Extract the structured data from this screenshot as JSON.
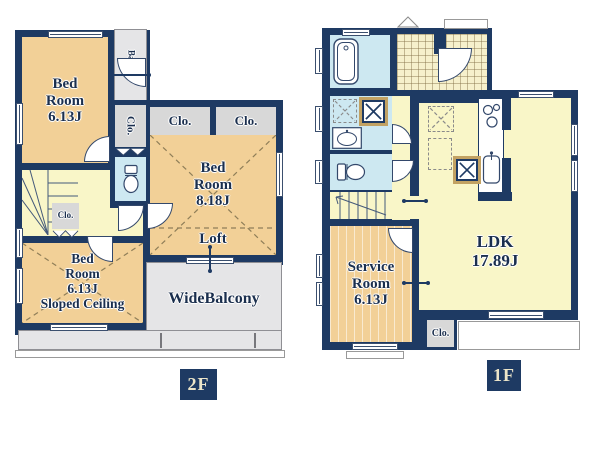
{
  "colors": {
    "wall": "#1e3a63",
    "room_tan": "#f2d097",
    "room_yellow": "#f9f6c8",
    "wet_blue": "#cde8f1",
    "closet_gray": "#d8d8d8",
    "balcony_gray": "#e5e5e7",
    "label": "#1b2f4e",
    "tag_text": "#ece5c9"
  },
  "floor2": {
    "tag": "2F",
    "bedroom_a": "Bed\nRoom\n6.13J",
    "balcony": "Balcony",
    "closet_side": "Clo.",
    "closet_hall": "Clo.",
    "closet_left": "Clo.",
    "closet_right": "Clo.",
    "bedroom_b": "Bed\nRoom\n8.18J",
    "loft": "Loft",
    "bedroom_c": "Bed\nRoom\n6.13J\nSloped Ceiling",
    "wide_balcony": "WideBalcony"
  },
  "floor1": {
    "tag": "1F",
    "ldk": "LDK\n17.89J",
    "service": "Service\nRoom\n6.13J",
    "closet": "Clo."
  }
}
